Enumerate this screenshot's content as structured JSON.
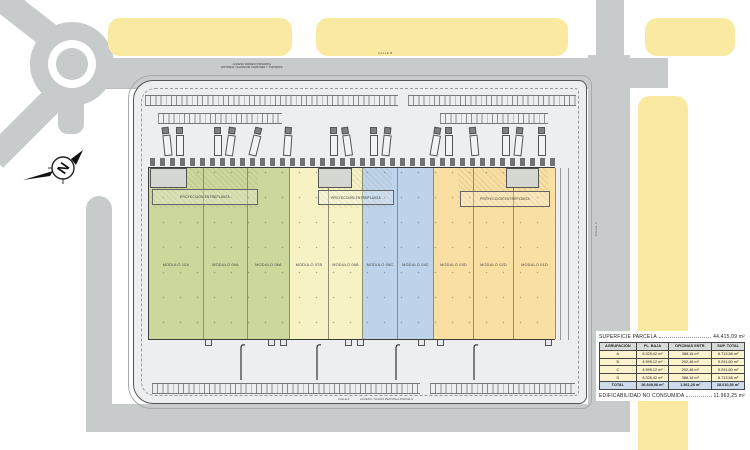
{
  "colors": {
    "group_A": "#ccd79b",
    "group_B": "#f6f2c4",
    "group_C": "#bdd3e9",
    "group_D": "#fadfa2",
    "parcel_yellow": "#fae9a1",
    "road_gray": "#c8cbcc",
    "site_gray": "#edeef0",
    "table_header_bg": "#d9dadb",
    "table_row_bg": "#fdf3cd",
    "table_total_bg": "#ccdcec"
  },
  "compass": {
    "north": "N"
  },
  "streets": {
    "calle_b": "CALLE B",
    "calle_a_right": "CALLE A",
    "calle_a_bottom": "CALLE A",
    "main_access_line1": "ACCESO RODADO PRINCIPAL",
    "main_access_line2": "ENTRADA / SALIDA DE CAMIONES Y TURISMOS",
    "pedestrian_access": "ACCESO / SALIDA PEATONAL PARCELA"
  },
  "plan": {
    "entreplanta_label": "PROYECCION ENTREPLANTA",
    "modules": [
      {
        "label": "MODULO 10A",
        "group": "A"
      },
      {
        "label": "MODULO 09A",
        "group": "A"
      },
      {
        "label": "MODULO 08A",
        "group": "A"
      },
      {
        "label": "MODULO 07B",
        "group": "B"
      },
      {
        "label": "MODULO 06B",
        "group": "B"
      },
      {
        "label": "MODULO 05C",
        "group": "C"
      },
      {
        "label": "MODULO 04C",
        "group": "C"
      },
      {
        "label": "MODULO 03D",
        "group": "D"
      },
      {
        "label": "MODULO 02D",
        "group": "D"
      },
      {
        "label": "MODULO 01D",
        "group": "D"
      }
    ]
  },
  "panel": {
    "superficie_label": "SUPERFICIE PARCELA",
    "superficie_value": "44.415,09 m²",
    "edificabilidad_label": "EDIFICABILIDAD NO CONSUMIDA",
    "edificabilidad_value": "11.963,25 m²",
    "table": {
      "headers": [
        "AGRUPACIÓN",
        "PL. BAJA",
        "OFICINAS ENTR.",
        "SUP. TOTAL"
      ],
      "rows": [
        [
          "A",
          "8.325,42 m²",
          "388,16 m²",
          "8.713,58 m²"
        ],
        [
          "B",
          "4.999,12 m²",
          "292,48 m²",
          "5.291,60 m²"
        ],
        [
          "C",
          "4.999,12 m²",
          "292,48 m²",
          "5.291,60 m²"
        ],
        [
          "D",
          "8.325,42 m²",
          "388,16 m²",
          "8.713,58 m²"
        ],
        [
          "TOTAL",
          "26.649,08 m²",
          "1.361,28 m²",
          "28.010,36 m²"
        ]
      ]
    }
  }
}
